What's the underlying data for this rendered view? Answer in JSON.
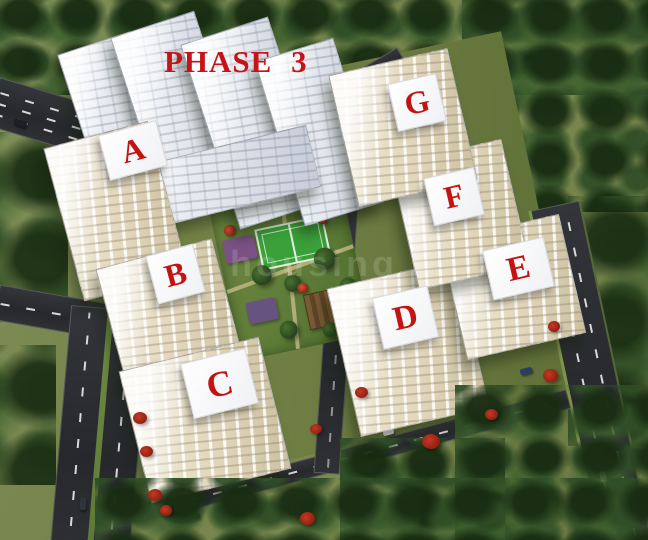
{
  "scene": {
    "phase_label": "PHASE 3",
    "watermark_text": "housing",
    "buildings": [
      {
        "id": "A",
        "label": "A"
      },
      {
        "id": "B",
        "label": "B"
      },
      {
        "id": "C",
        "label": "C"
      },
      {
        "id": "D",
        "label": "D"
      },
      {
        "id": "E",
        "label": "E"
      },
      {
        "id": "F",
        "label": "F"
      },
      {
        "id": "G",
        "label": "G"
      }
    ],
    "colors": {
      "label_red": "#c31313",
      "grass_olive": "#76854b",
      "forest_green": "#2f4d26",
      "road_asphalt": "#2b2d31",
      "building_white": "#edeff3",
      "building_cream": "#e4dabf",
      "courtyard_green": "#5e7c38",
      "tennis_green": "#3aa13a",
      "flower_red": "#a82a1d",
      "road_median_green": "#6f8c42"
    }
  }
}
